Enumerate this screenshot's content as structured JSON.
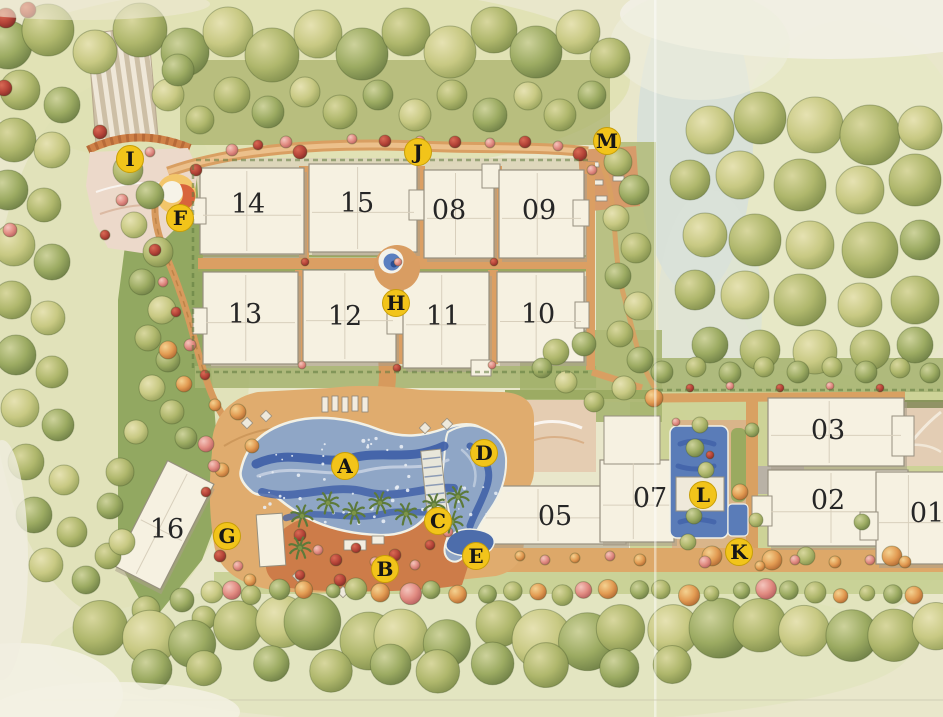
{
  "plan": {
    "type": "site-plan",
    "buildings": [
      {
        "label": "14",
        "x": 200,
        "y": 168,
        "w": 104,
        "h": 86,
        "rot": 0,
        "nx": 248,
        "ny": 204
      },
      {
        "label": "15",
        "x": 309,
        "y": 164,
        "w": 108,
        "h": 88,
        "rot": 0,
        "nx": 357,
        "ny": 203
      },
      {
        "label": "08",
        "x": 424,
        "y": 170,
        "w": 70,
        "h": 88,
        "rot": 0,
        "nx": 449,
        "ny": 210
      },
      {
        "label": "09",
        "x": 499,
        "y": 170,
        "w": 85,
        "h": 88,
        "rot": 0,
        "nx": 539,
        "ny": 210
      },
      {
        "label": "13",
        "x": 203,
        "y": 272,
        "w": 95,
        "h": 92,
        "rot": 0,
        "nx": 245,
        "ny": 314
      },
      {
        "label": "12",
        "x": 303,
        "y": 270,
        "w": 93,
        "h": 92,
        "rot": 0,
        "nx": 345,
        "ny": 316
      },
      {
        "label": "11",
        "x": 403,
        "y": 272,
        "w": 86,
        "h": 96,
        "rot": 0,
        "nx": 443,
        "ny": 316
      },
      {
        "label": "10",
        "x": 497,
        "y": 272,
        "w": 87,
        "h": 90,
        "rot": 0,
        "nx": 538,
        "ny": 314
      },
      {
        "label": "16",
        "x": 138,
        "y": 466,
        "w": 52,
        "h": 118,
        "rot": 27,
        "nx": 167,
        "ny": 529
      },
      {
        "label": "05",
        "x": 466,
        "y": 486,
        "w": 160,
        "h": 58,
        "rot": 0,
        "nx": 555,
        "ny": 516
      },
      {
        "label": "07",
        "x": 600,
        "y": 460,
        "w": 74,
        "h": 82,
        "rot": 0,
        "nx": 650,
        "ny": 498
      },
      {
        "label": "03",
        "x": 768,
        "y": 398,
        "w": 136,
        "h": 68,
        "rot": 0,
        "nx": 828,
        "ny": 430
      },
      {
        "label": "02",
        "x": 768,
        "y": 470,
        "w": 140,
        "h": 76,
        "rot": 0,
        "nx": 828,
        "ny": 500
      },
      {
        "label": "01",
        "x": 876,
        "y": 472,
        "w": 72,
        "h": 92,
        "rot": 0,
        "nx": 927,
        "ny": 513
      }
    ],
    "markers": [
      {
        "label": "A",
        "x": 345,
        "y": 466
      },
      {
        "label": "B",
        "x": 385,
        "y": 569
      },
      {
        "label": "C",
        "x": 438,
        "y": 521
      },
      {
        "label": "D",
        "x": 484,
        "y": 453
      },
      {
        "label": "E",
        "x": 476,
        "y": 556
      },
      {
        "label": "F",
        "x": 180,
        "y": 218
      },
      {
        "label": "G",
        "x": 227,
        "y": 536
      },
      {
        "label": "H",
        "x": 396,
        "y": 303
      },
      {
        "label": "I",
        "x": 130,
        "y": 159
      },
      {
        "label": "J",
        "x": 418,
        "y": 152
      },
      {
        "label": "K",
        "x": 739,
        "y": 552
      },
      {
        "label": "L",
        "x": 703,
        "y": 495
      },
      {
        "label": "M",
        "x": 607,
        "y": 141
      }
    ],
    "palette": {
      "marker_yellow": "#f2c41a",
      "marker_letter": "#161616",
      "building_fill": "#f6f1e1",
      "building_stroke": "#97907f",
      "building_shadow": "#a99f8a",
      "number_color": "#262626",
      "pool_blue": "#8fa6c6",
      "pool_band_blue": "#3d5ea6",
      "path_orange": "#d99f62",
      "deck_tan": "#e0ac6e",
      "garden_terracotta": "#cd7c49",
      "lawn_green": "#c6cf92",
      "tree_green": "#a9b468",
      "background": "#e9e7cb"
    }
  }
}
